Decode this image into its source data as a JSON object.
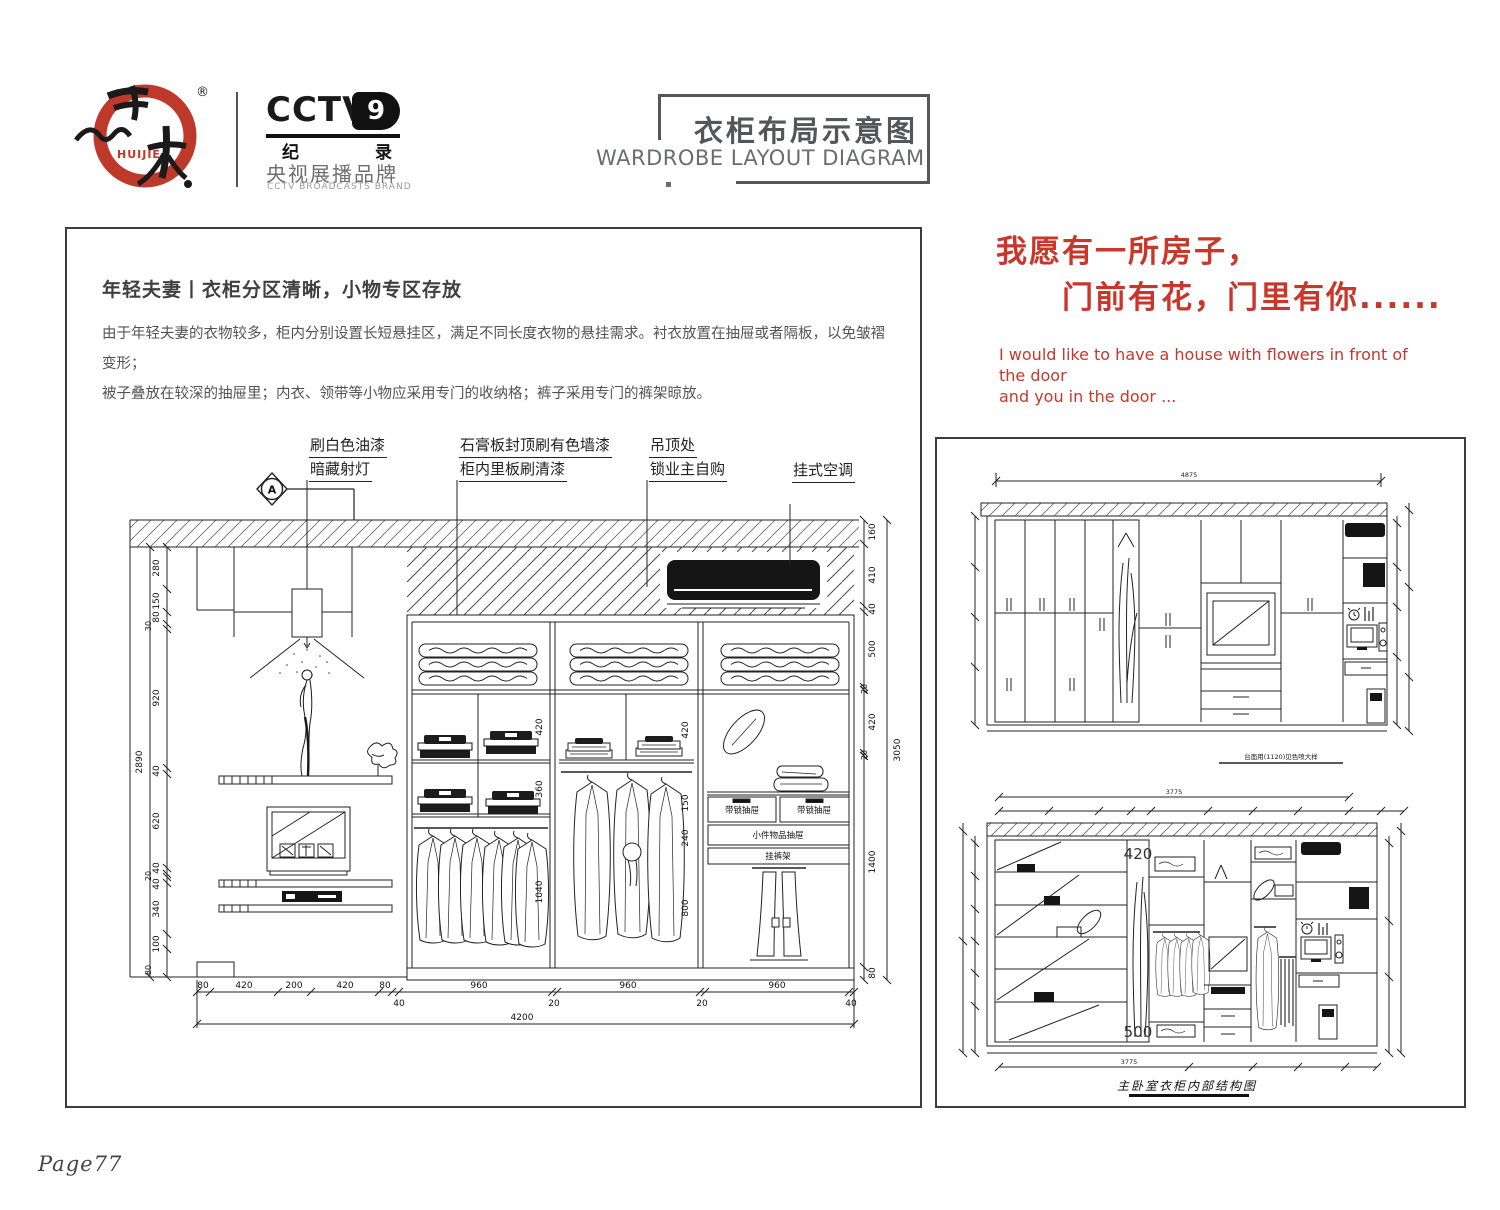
{
  "colors": {
    "accent_red": "#c8372a",
    "title_gray": "#55565a",
    "line_black": "#222222"
  },
  "page": {
    "page_number": "Page77"
  },
  "header": {
    "brand_en": "HUIJIE",
    "registered": "®",
    "cctv_logo": "CCTV",
    "cctv_num": "9",
    "cctv_ji": "纪",
    "cctv_lu": "录",
    "cctv_line1": "央视展播品牌",
    "cctv_line2": "CCTV BROADCASTS BRAND",
    "title_zh": "衣柜布局示意图",
    "title_en": "WARDROBE LAYOUT DIAGRAM"
  },
  "slogan": {
    "line1": "我愿有一所房子，",
    "line2": "门前有花，门里有你......",
    "en_line1": "I would like to have a house with flowers in front of the door",
    "en_line2": "and you in the door ..."
  },
  "intro": {
    "heading": "年轻夫妻丨衣柜分区清晰，小物专区存放",
    "body_line1": "由于年轻夫妻的衣物较多，柜内分别设置长短悬挂区，满足不同长度衣物的悬挂需求。衬衣放置在抽屉或者隔板，以免皱褶变形；",
    "body_line2": "被子叠放在较深的抽屉里；内衣、领带等小物应采用专门的收纳格；裤子采用专门的裤架晾放。"
  },
  "main_drawing": {
    "section_marker": "A",
    "callouts": {
      "c1a": "刷白色油漆",
      "c1b": "暗藏射灯",
      "c2a": "石膏板封顶刷有色墙漆",
      "c2b": "柜内里板刷清漆",
      "c3a": "吊顶处",
      "c3b": "锁业主自购",
      "c4": "挂式空调"
    },
    "labels": {
      "locked_drawer": "带锁抽屉",
      "small_items_drawer": "小件物品抽屉",
      "pants_rack": "挂裤架"
    },
    "dims_left": [
      "280",
      "150",
      "80",
      "30",
      "920",
      "40",
      "620",
      "40",
      "20",
      "40",
      "340",
      "100",
      "80"
    ],
    "dims_left_total": "2890",
    "dims_right": [
      "160",
      "410",
      "40",
      "500",
      "20",
      "420",
      "20",
      "1400",
      "80"
    ],
    "dims_right_total": "3050",
    "dims_bottom_row1": [
      "80",
      "420",
      "200",
      "420",
      "80",
      "960",
      "960",
      "960"
    ],
    "dims_bottom_row2": [
      "40",
      "20",
      "20",
      "40"
    ],
    "dims_bottom_total": "4200",
    "dims_inner_bay1": [
      "420",
      "360",
      "1040"
    ],
    "dims_inner_bay2": [
      "420",
      "150",
      "240",
      "800"
    ]
  },
  "right_panel": {
    "top_drawing": {
      "total_width": "4875",
      "note": "台面用(1120)见色喷大样"
    },
    "bottom_drawing": {
      "total_width_top": "3775",
      "total_width_bottom": "3775",
      "niche_dim_top": "420",
      "niche_dim_bottom": "500",
      "caption": "主卧室衣柜内部结构图"
    }
  }
}
